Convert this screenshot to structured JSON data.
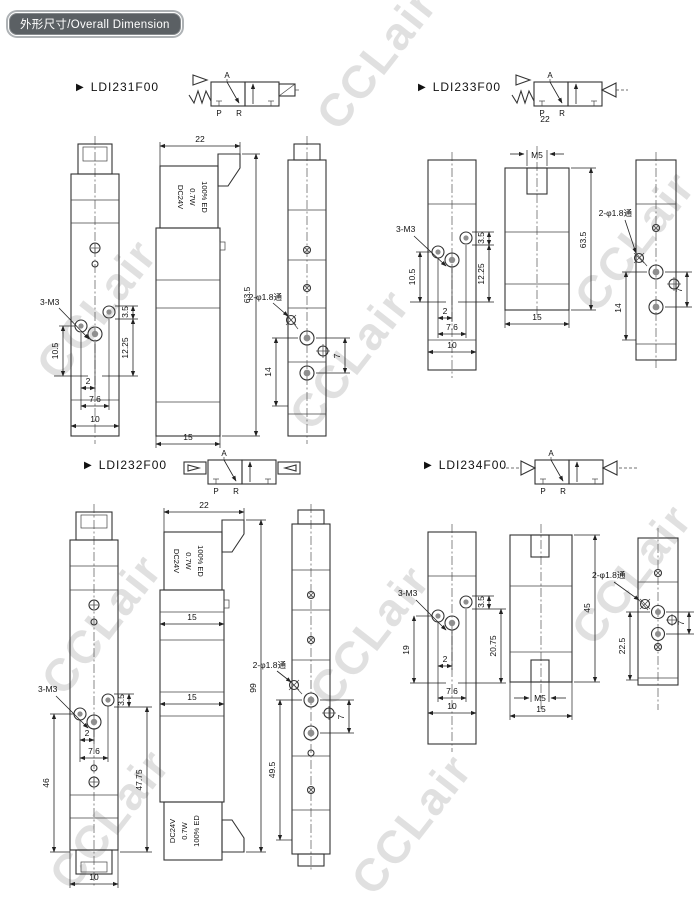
{
  "header": {
    "title": "外形尺寸/Overall Dimension"
  },
  "watermark": {
    "text": "CCLair"
  },
  "ports": {
    "a": "A",
    "p": "P",
    "r": "R"
  },
  "coil": {
    "l1": "DC24V",
    "l2": "0.7W",
    "l3": "100% ED"
  },
  "groups": [
    {
      "model": "LDI231F00",
      "front": {
        "thread": "3-M3",
        "offset": "3.5",
        "left": "10.5",
        "right": "12.25",
        "b1": "2",
        "b2": "7.6",
        "b3": "10"
      },
      "side": {
        "width": "22",
        "height": "63.5",
        "base": "15"
      },
      "back": {
        "holes": "2-φ1.8通",
        "left": "14",
        "right": "7"
      }
    },
    {
      "model": "LDI233F00",
      "front": {
        "thread": "3-M3",
        "offset": "3.5",
        "left": "10.5",
        "right": "12.25",
        "b1": "2",
        "b2": "7.6",
        "b3": "10"
      },
      "side": {
        "width": "22",
        "thread": "M5",
        "height": "63.5",
        "base": "15"
      },
      "back": {
        "holes": "2-φ1.8通",
        "left": "14",
        "right": "7"
      }
    },
    {
      "model": "LDI232F00",
      "front": {
        "thread": "3-M3",
        "offset": "3.5",
        "left": "46",
        "right": "47.75",
        "b1": "2",
        "b2": "7.6",
        "b3": "10"
      },
      "side": {
        "width": "22",
        "mid1": "15",
        "mid2": "15",
        "height": "99"
      },
      "back": {
        "holes": "2-φ1.8通",
        "left": "49.5",
        "right": "7"
      }
    },
    {
      "model": "LDI234F00",
      "front": {
        "thread": "3-M3",
        "offset": "3.5",
        "left": "19",
        "right": "20.75",
        "b1": "2",
        "b2": "7.6",
        "b3": "10"
      },
      "side": {
        "thread": "M5",
        "height": "45",
        "base": "15"
      },
      "back": {
        "holes": "2-φ1.8通",
        "left": "22.5",
        "right": "7"
      }
    }
  ]
}
